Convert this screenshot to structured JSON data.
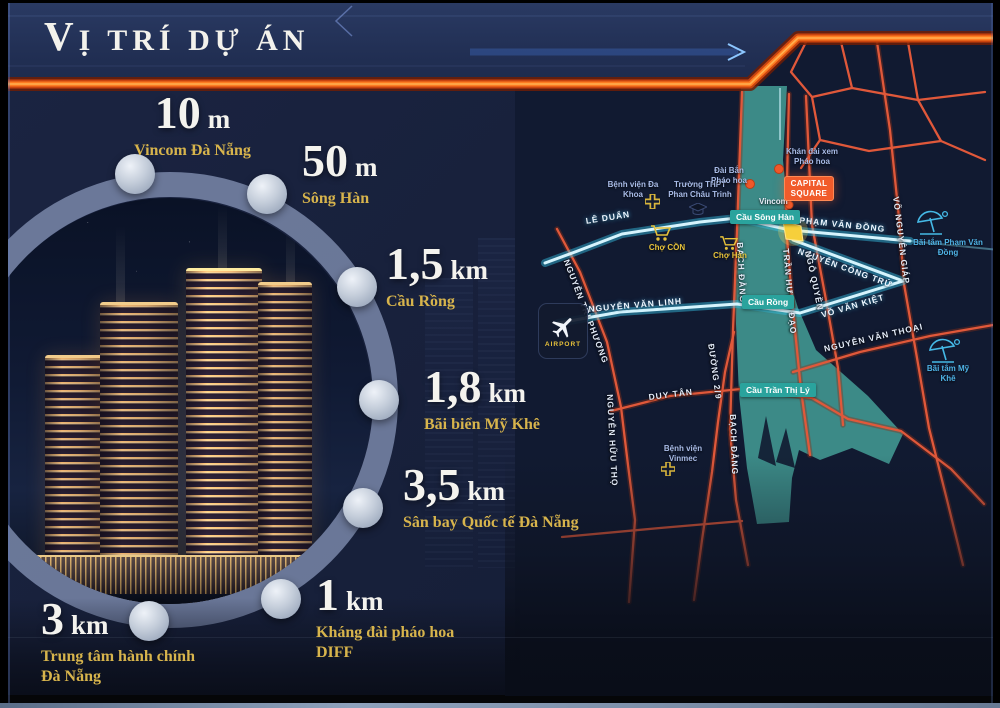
{
  "title": "VỊ TRÍ DỰ ÁN",
  "callouts": [
    {
      "value": "10",
      "unit": "m",
      "label": "Vincom Đà Nẵng"
    },
    {
      "value": "50",
      "unit": "m",
      "label": "Sông Hàn"
    },
    {
      "value": "1,5",
      "unit": "km",
      "label": "Cầu Rồng"
    },
    {
      "value": "1,8",
      "unit": "km",
      "label": "Bãi biển Mỹ Khê"
    },
    {
      "value": "3,5",
      "unit": "km",
      "label": "Sân bay Quốc tế Đà Nẵng"
    },
    {
      "value": "1",
      "unit": "km",
      "label": "Kháng đài pháo hoa DIFF"
    },
    {
      "value": "3",
      "unit": "km",
      "label": "Trung tâm hành chính Đà Nẵng"
    }
  ],
  "map": {
    "streets": {
      "le_duan": "LÊ DUẨN",
      "pham_van_dong": "PHẠM VĂN ĐỒNG",
      "nguyen_cong_tru": "NGUYỄN CÔNG TRỨ",
      "vo_nguyen_giap": "VÕ NGUYÊN GIÁP",
      "vo_van_kiet": "VÕ VĂN KIỆT",
      "nguyen_van_linh": "NGUYỄN VĂN LINH",
      "nguyen_van_thoai": "NGUYỄN VĂN THOẠI",
      "nguyen_tri_phuong": "NGUYỄN TRI PHƯƠNG",
      "tran_hung_dao": "TRẦN HƯNG ĐẠO",
      "ngo_quyen": "NGÔ QUYỀN",
      "bach_dang": "BẠCH ĐẰNG",
      "duong_29": "ĐƯỜNG 2/9",
      "duy_tan": "DUY TÂN",
      "nguyen_huu_tho": "NGUYỄN HỮU THỌ"
    },
    "bridges": {
      "song_han": "Cầu Sông Hàn",
      "rong": "Cầu Rồng",
      "tran_thi_ly": "Cầu Trần Thị Lý"
    },
    "pois": {
      "benh_vien_da_khoa": "Bệnh viện Đa Khoa",
      "truong_thpt": "Trường THPT Phan Châu Trinh",
      "dai_ban_phao_hoa": "Đài Bắn Pháo hoa",
      "khan_dai": "Khán đài xem Pháo hoa",
      "vincom": "Vincom",
      "capital_square": "CAPITAL SQUARE",
      "cho_con": "Chợ CỒN",
      "cho_han": "Chợ Hàn",
      "benh_vien_vinmec": "Bệnh viện Vinmec",
      "bai_tam_pvd": "Bãi tắm Phạm Văn Đồng",
      "bai_tam_my_khe": "Bãi tắm Mỹ Khê",
      "airport": "AIRPORT"
    }
  },
  "colors": {
    "accent_stripe": "#ff7c22",
    "river": "#3e8e8a",
    "road_orange": "#e0583a",
    "road_cyan": "#d6f4fd",
    "gold_label": "#d7b44c",
    "badge_teal": "#2aa39d",
    "capital_orange": "#f15b2b",
    "site_yellow": "#f6cf3b"
  }
}
